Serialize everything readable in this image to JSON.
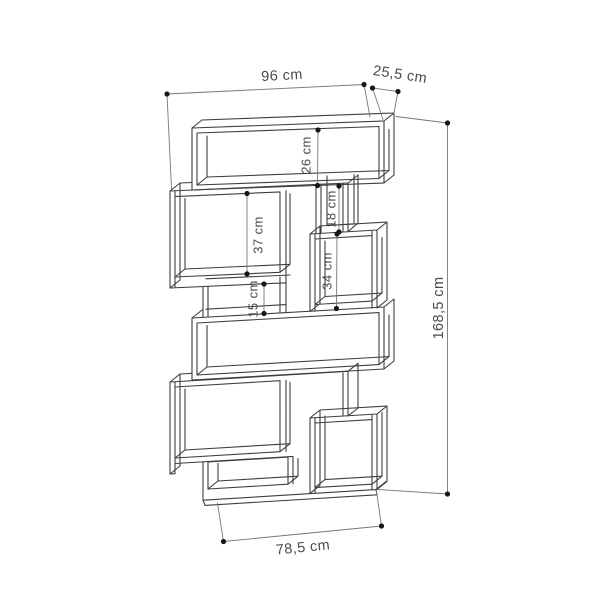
{
  "title": "Bookcase dimension drawing",
  "canvas": {
    "background": "#ffffff",
    "furniture_line_color": "#3e3e3e",
    "dimension_line_color": "#777777",
    "dot_color": "#161616",
    "text_color": "#4a4a4a"
  },
  "unit": "cm",
  "dimensions": {
    "overall_width": "96 cm",
    "depth": "25,5 cm",
    "top_compartment_height": "26 cm",
    "upper_left_compartment_height": "37 cm",
    "right_cubby_height": "18 cm",
    "right_box_height": "34 cm",
    "lower_slot_height": "15 cm",
    "overall_height": "168,5 cm",
    "base_width": "78,5 cm"
  }
}
